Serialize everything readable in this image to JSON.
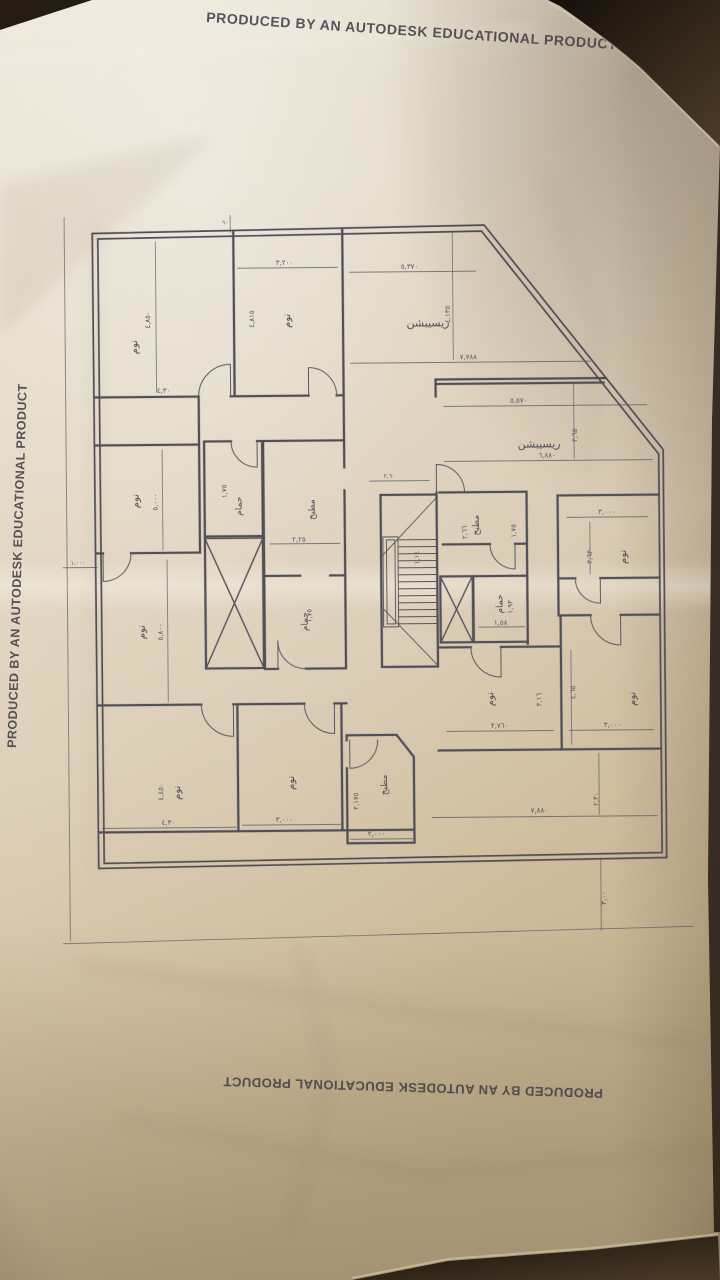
{
  "autodesk_stamp": {
    "text": "PRODUCED BY AN AUTODESK EDUCATIONAL PRODUCT"
  },
  "plan": {
    "room_names": {
      "bedroom": "نوم",
      "bathroom": "حمام",
      "kitchen": "مطبخ",
      "reception": "ريسيبشن"
    },
    "dims": [
      "٤,٨٥٠",
      "٤,٣٠",
      "٣,٢٠٠",
      "٤,٨١٥",
      "٥,٣٧٠",
      "٤,١٣٥",
      "٧,٧٨٨",
      "٥,٥٧٠",
      "٦,٨٨٠",
      "٣,٦٥",
      "٣,٠٠٠",
      "٣,٦٣٠",
      "٥,٠٠٠",
      "٥,٨٠٠",
      "١,٧٥",
      "٢,٢٥",
      "١,٧٥",
      "٢,٦٦",
      "١,٧٥",
      "١,٩٣",
      "١,٥٨",
      "١,١٤",
      "٣,٧٦٠",
      "٣,٠٠٠",
      "٤,٦٥",
      "٣,١٦",
      "٧,٨٨٠",
      "٢,٣٠",
      "٤,٤٥٠",
      "٤,٣٠",
      "٣,٠٠٠",
      "٣,١٧٥",
      "٢,٠٠٠",
      "٣,٠٠",
      "١,٠٠٠",
      "٦٠",
      "٢,٦٠"
    ]
  },
  "colors": {
    "paper": "#e6dcc6",
    "background_dark": "#241c15",
    "wall_ink": "#504e58",
    "stamp_ink": "#413e46"
  }
}
